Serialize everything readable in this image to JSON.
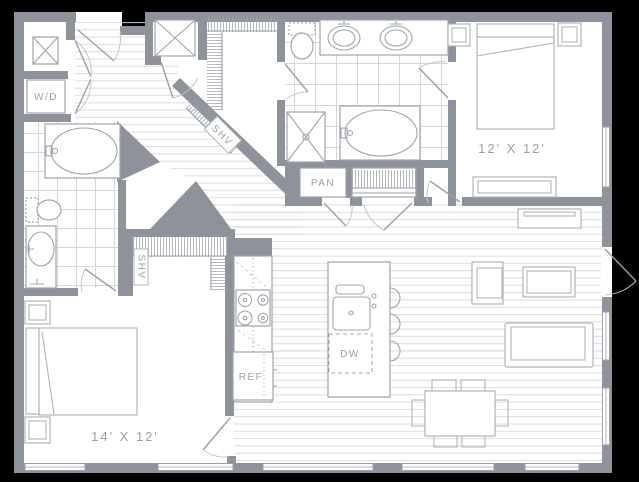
{
  "colors": {
    "background": "#000000",
    "wall": "#8d929b",
    "floor": "#ffffff",
    "plank_line": "#d9dbdf",
    "tile_line": "#d3d6da",
    "fixture_line": "#9fa4ac",
    "furniture_line": "#b0b4ba",
    "label_text": "#9aa0a9"
  },
  "labels": {
    "washer_dryer": "W/D",
    "walk_in_closet_shelf": "SHV",
    "bedroom2_closet_shelf": "SHV",
    "pantry": "PAN",
    "dishwasher": "DW",
    "refrigerator": "REF"
  },
  "rooms": [
    {
      "name": "primary-bedroom",
      "dimensions": "12' X 12'"
    },
    {
      "name": "second-bedroom",
      "dimensions": "14' X 12'"
    }
  ]
}
